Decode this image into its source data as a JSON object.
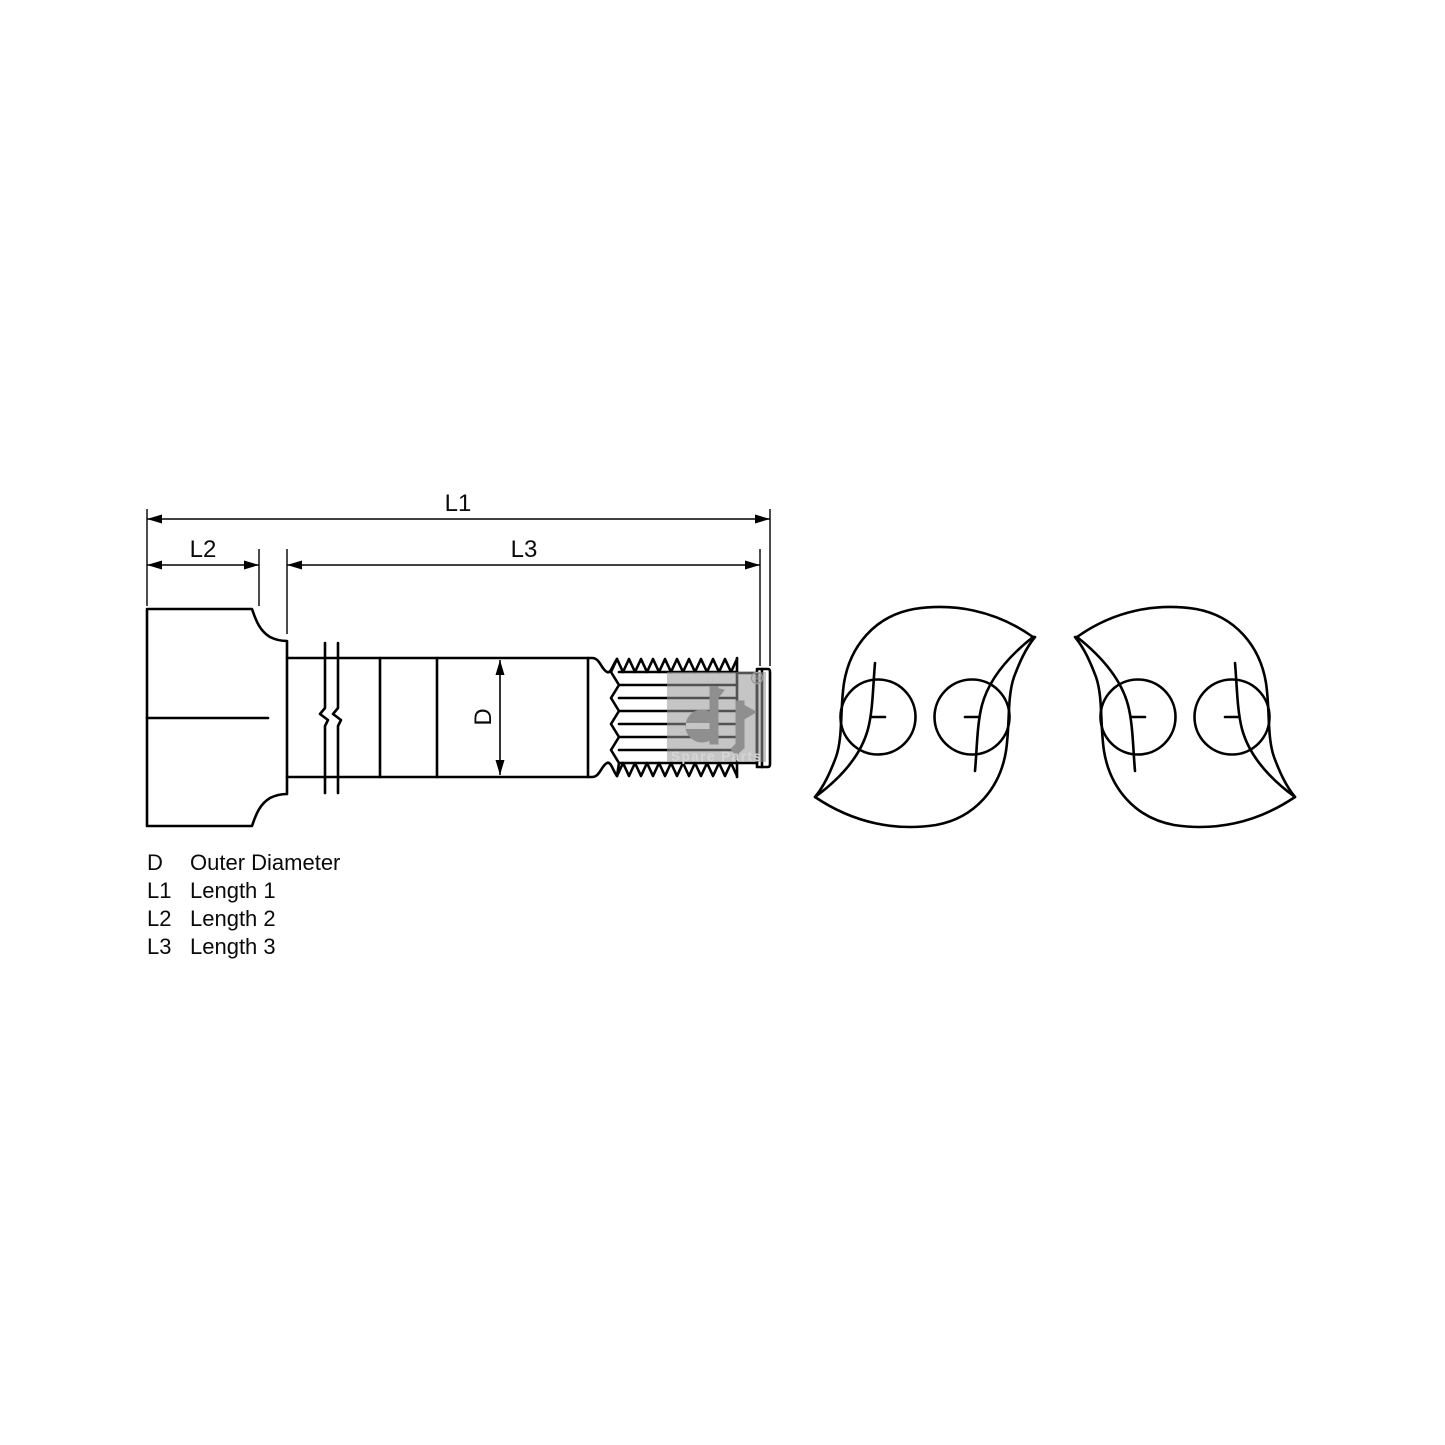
{
  "page": {
    "background": "#ffffff",
    "line_color": "#000000",
    "watermark_gray": "#9a9a9a"
  },
  "dimensions": {
    "l1": "L1",
    "l2": "L2",
    "l3": "L3",
    "d": "D"
  },
  "legend": {
    "rows": [
      {
        "term": "D",
        "desc": "Outer Diameter"
      },
      {
        "term": "L1",
        "desc": "Length 1"
      },
      {
        "term": "L2",
        "desc": "Length 2"
      },
      {
        "term": "L3",
        "desc": "Length 3"
      }
    ]
  },
  "watermark": {
    "registered": "®",
    "tagline": "Spare Parts"
  }
}
